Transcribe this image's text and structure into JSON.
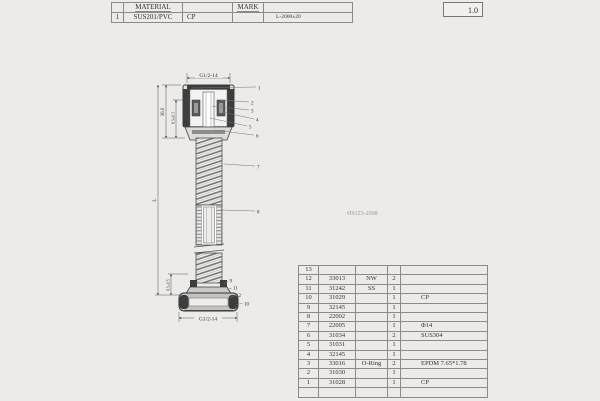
{
  "title_block": {
    "material_label": "MATERIAL",
    "mark_label": "MARK",
    "row_no": "1",
    "material_value": "SUS201/PVC",
    "finish_value": "CP",
    "length_spec": "L-2000±20",
    "version": "1.0"
  },
  "drawing": {
    "dim_top_thread": "G1/2-14",
    "dim_height": "36.0",
    "dim_inner": "8.5±0.5",
    "dim_length": "L",
    "dim_bottom_offset": "8.5±0.5",
    "dim_bottom_thread": "G1/2-14",
    "note": "HS123-2008",
    "callouts": [
      "1",
      "2",
      "3",
      "4",
      "5",
      "6",
      "7",
      "8",
      "9",
      "11",
      "12",
      "10"
    ]
  },
  "bom": {
    "rows": [
      [
        "13",
        "",
        "",
        "",
        ""
      ],
      [
        "12",
        "33013",
        "NW",
        "2",
        ""
      ],
      [
        "11",
        "31242",
        "SS",
        "1",
        ""
      ],
      [
        "10",
        "31029",
        "",
        "1",
        "CP"
      ],
      [
        "9",
        "32145",
        "",
        "1",
        ""
      ],
      [
        "8",
        "22002",
        "",
        "1",
        ""
      ],
      [
        "7",
        "22005",
        "",
        "1",
        "Φ14"
      ],
      [
        "6",
        "31034",
        "",
        "2",
        "SUS304"
      ],
      [
        "5",
        "31031",
        "",
        "1",
        ""
      ],
      [
        "4",
        "32145",
        "",
        "1",
        ""
      ],
      [
        "3",
        "33016",
        "O-Ring",
        "2",
        "EPDM 7.65*1.78"
      ],
      [
        "2",
        "31030",
        "",
        "1",
        ""
      ],
      [
        "1",
        "31028",
        "",
        "1",
        "CP"
      ],
      [
        "",
        "",
        "",
        "",
        ""
      ]
    ]
  },
  "colors": {
    "line": "#555555",
    "dark": "#3d3d3d",
    "bg": "#ecebe9"
  }
}
